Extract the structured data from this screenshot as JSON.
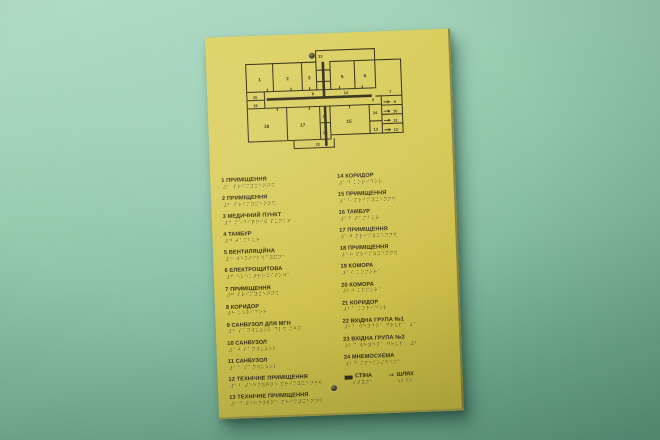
{
  "colors": {
    "wall": "#8fc7ab",
    "sign_face": "#d4c754",
    "ink": "#332c16"
  },
  "sign": {
    "plan": {
      "room_labels": [
        "1",
        "2",
        "3",
        "4",
        "5",
        "6",
        "7",
        "8",
        "9",
        "10",
        "11",
        "12",
        "13",
        "14",
        "15",
        "16",
        "17",
        "18",
        "19",
        "20",
        "21",
        "22",
        "23",
        "24"
      ]
    },
    "legend_left": [
      {
        "num": "1",
        "name": "ПРИМІЩЕННЯ",
        "braille": "⠼⠁ ⠏⠗⠊⠍⠽⠭⠑⠝⠝⠫"
      },
      {
        "num": "2",
        "name": "ПРИМІЩЕННЯ",
        "braille": "⠼⠃ ⠏⠗⠊⠍⠽⠭⠑⠝⠝⠫"
      },
      {
        "num": "3",
        "name": "МЕДИЧНИЙ ПУНКТ",
        "braille": "⠼⠉ ⠍⠑⠙⠊⠟⠝⠊⠯ ⠏⠥⠝⠅⠞"
      },
      {
        "num": "4",
        "name": "ТАМБУР",
        "braille": "⠼⠙ ⠞⠁⠍⠃⠥⠗"
      },
      {
        "num": "5",
        "name": "ВЕНТИЛЯЦІЙНА",
        "braille": "⠼⠑ ⠺⠑⠝⠞⠊⠇⠫⠉⠽⠯⠝⠁"
      },
      {
        "num": "6",
        "name": "ЕЛЕКТРОЩИТОВА",
        "braille": "⠼⠋ ⠑⠇⠑⠅⠞⠗⠕⠭⠊⠞⠕⠺⠁"
      },
      {
        "num": "7",
        "name": "ПРИМІЩЕННЯ",
        "braille": "⠼⠛ ⠏⠗⠊⠍⠽⠭⠑⠝⠝⠫"
      },
      {
        "num": "8",
        "name": "КОРИДОР",
        "braille": "⠼⠓ ⠅⠕⠗⠊⠙⠕⠗"
      },
      {
        "num": "9",
        "name": "САНВУЗОЛ ДЛЯ МГН",
        "braille": "⠼⠊ ⠎⠁⠝⠺⠥⠵⠕⠇ ⠙⠇⠫ ⠍⠛⠝"
      },
      {
        "num": "10",
        "name": "САНВУЗОЛ",
        "braille": "⠼⠁⠚ ⠎⠁⠝⠺⠥⠵⠕⠇"
      },
      {
        "num": "11",
        "name": "САНВУЗОЛ",
        "braille": "⠼⠁⠁ ⠎⠁⠝⠺⠥⠵⠕⠇"
      },
      {
        "num": "12",
        "name": "ТЕХНІЧНЕ ПРИМІЩЕННЯ",
        "braille": "⠼⠁⠃ ⠞⠑⠓⠝⠽⠟⠝⠑ ⠏⠗⠊⠍⠽⠭⠑⠝⠝⠫"
      },
      {
        "num": "13",
        "name": "ТЕХНІЧНЕ ПРИМІЩЕННЯ",
        "braille": "⠼⠁⠉ ⠞⠑⠓⠝⠽⠟⠝⠑ ⠏⠗⠊⠍⠽⠭⠑⠝⠝⠫"
      }
    ],
    "legend_right": [
      {
        "num": "14",
        "name": "КОРИДОР",
        "braille": "⠼⠁⠙ ⠅⠕⠗⠊⠙⠕⠗"
      },
      {
        "num": "15",
        "name": "ПРИМІЩЕННЯ",
        "braille": "⠼⠁⠑ ⠏⠗⠊⠍⠽⠭⠑⠝⠝⠫"
      },
      {
        "num": "16",
        "name": "ТАМБУР",
        "braille": "⠼⠁⠋ ⠞⠁⠍⠃⠥⠗"
      },
      {
        "num": "17",
        "name": "ПРИМІЩЕННЯ",
        "braille": "⠼⠁⠛ ⠏⠗⠊⠍⠽⠭⠑⠝⠝⠫"
      },
      {
        "num": "18",
        "name": "ПРИМІЩЕННЯ",
        "braille": "⠼⠁⠓ ⠏⠗⠊⠍⠽⠭⠑⠝⠝⠫"
      },
      {
        "num": "19",
        "name": "КОМОРА",
        "braille": "⠼⠁⠊ ⠅⠕⠍⠕⠗⠁"
      },
      {
        "num": "20",
        "name": "КОМОРА",
        "braille": "⠼⠃⠚ ⠅⠕⠍⠕⠗⠁"
      },
      {
        "num": "21",
        "name": "КОРИДОР",
        "braille": "⠼⠃⠁ ⠅⠕⠗⠊⠙⠕⠗"
      },
      {
        "num": "22",
        "name": "ВХІДНА ГРУПА №1",
        "braille": "⠼⠃⠃ ⠺⠓⠽⠙⠝⠁ ⠛⠗⠥⠏⠁ ⠼⠁"
      },
      {
        "num": "23",
        "name": "ВХІДНА ГРУПА №2",
        "braille": "⠼⠃⠉ ⠺⠓⠽⠙⠝⠁ ⠛⠗⠥⠏⠁ ⠼⠃"
      },
      {
        "num": "24",
        "name": "МНЕМОСХЕМА",
        "braille": "⠼⠃⠙ ⠍⠝⠑⠍⠕⠎⠓⠑⠍⠁"
      }
    ],
    "key": {
      "wall_label": "СТІНА",
      "wall_braille": "⠎⠞⠽⠝⠁",
      "path_label": "ШЛЯХ",
      "path_braille": "⠱⠇⠫⠓",
      "path_arrow_char": "➞"
    }
  }
}
